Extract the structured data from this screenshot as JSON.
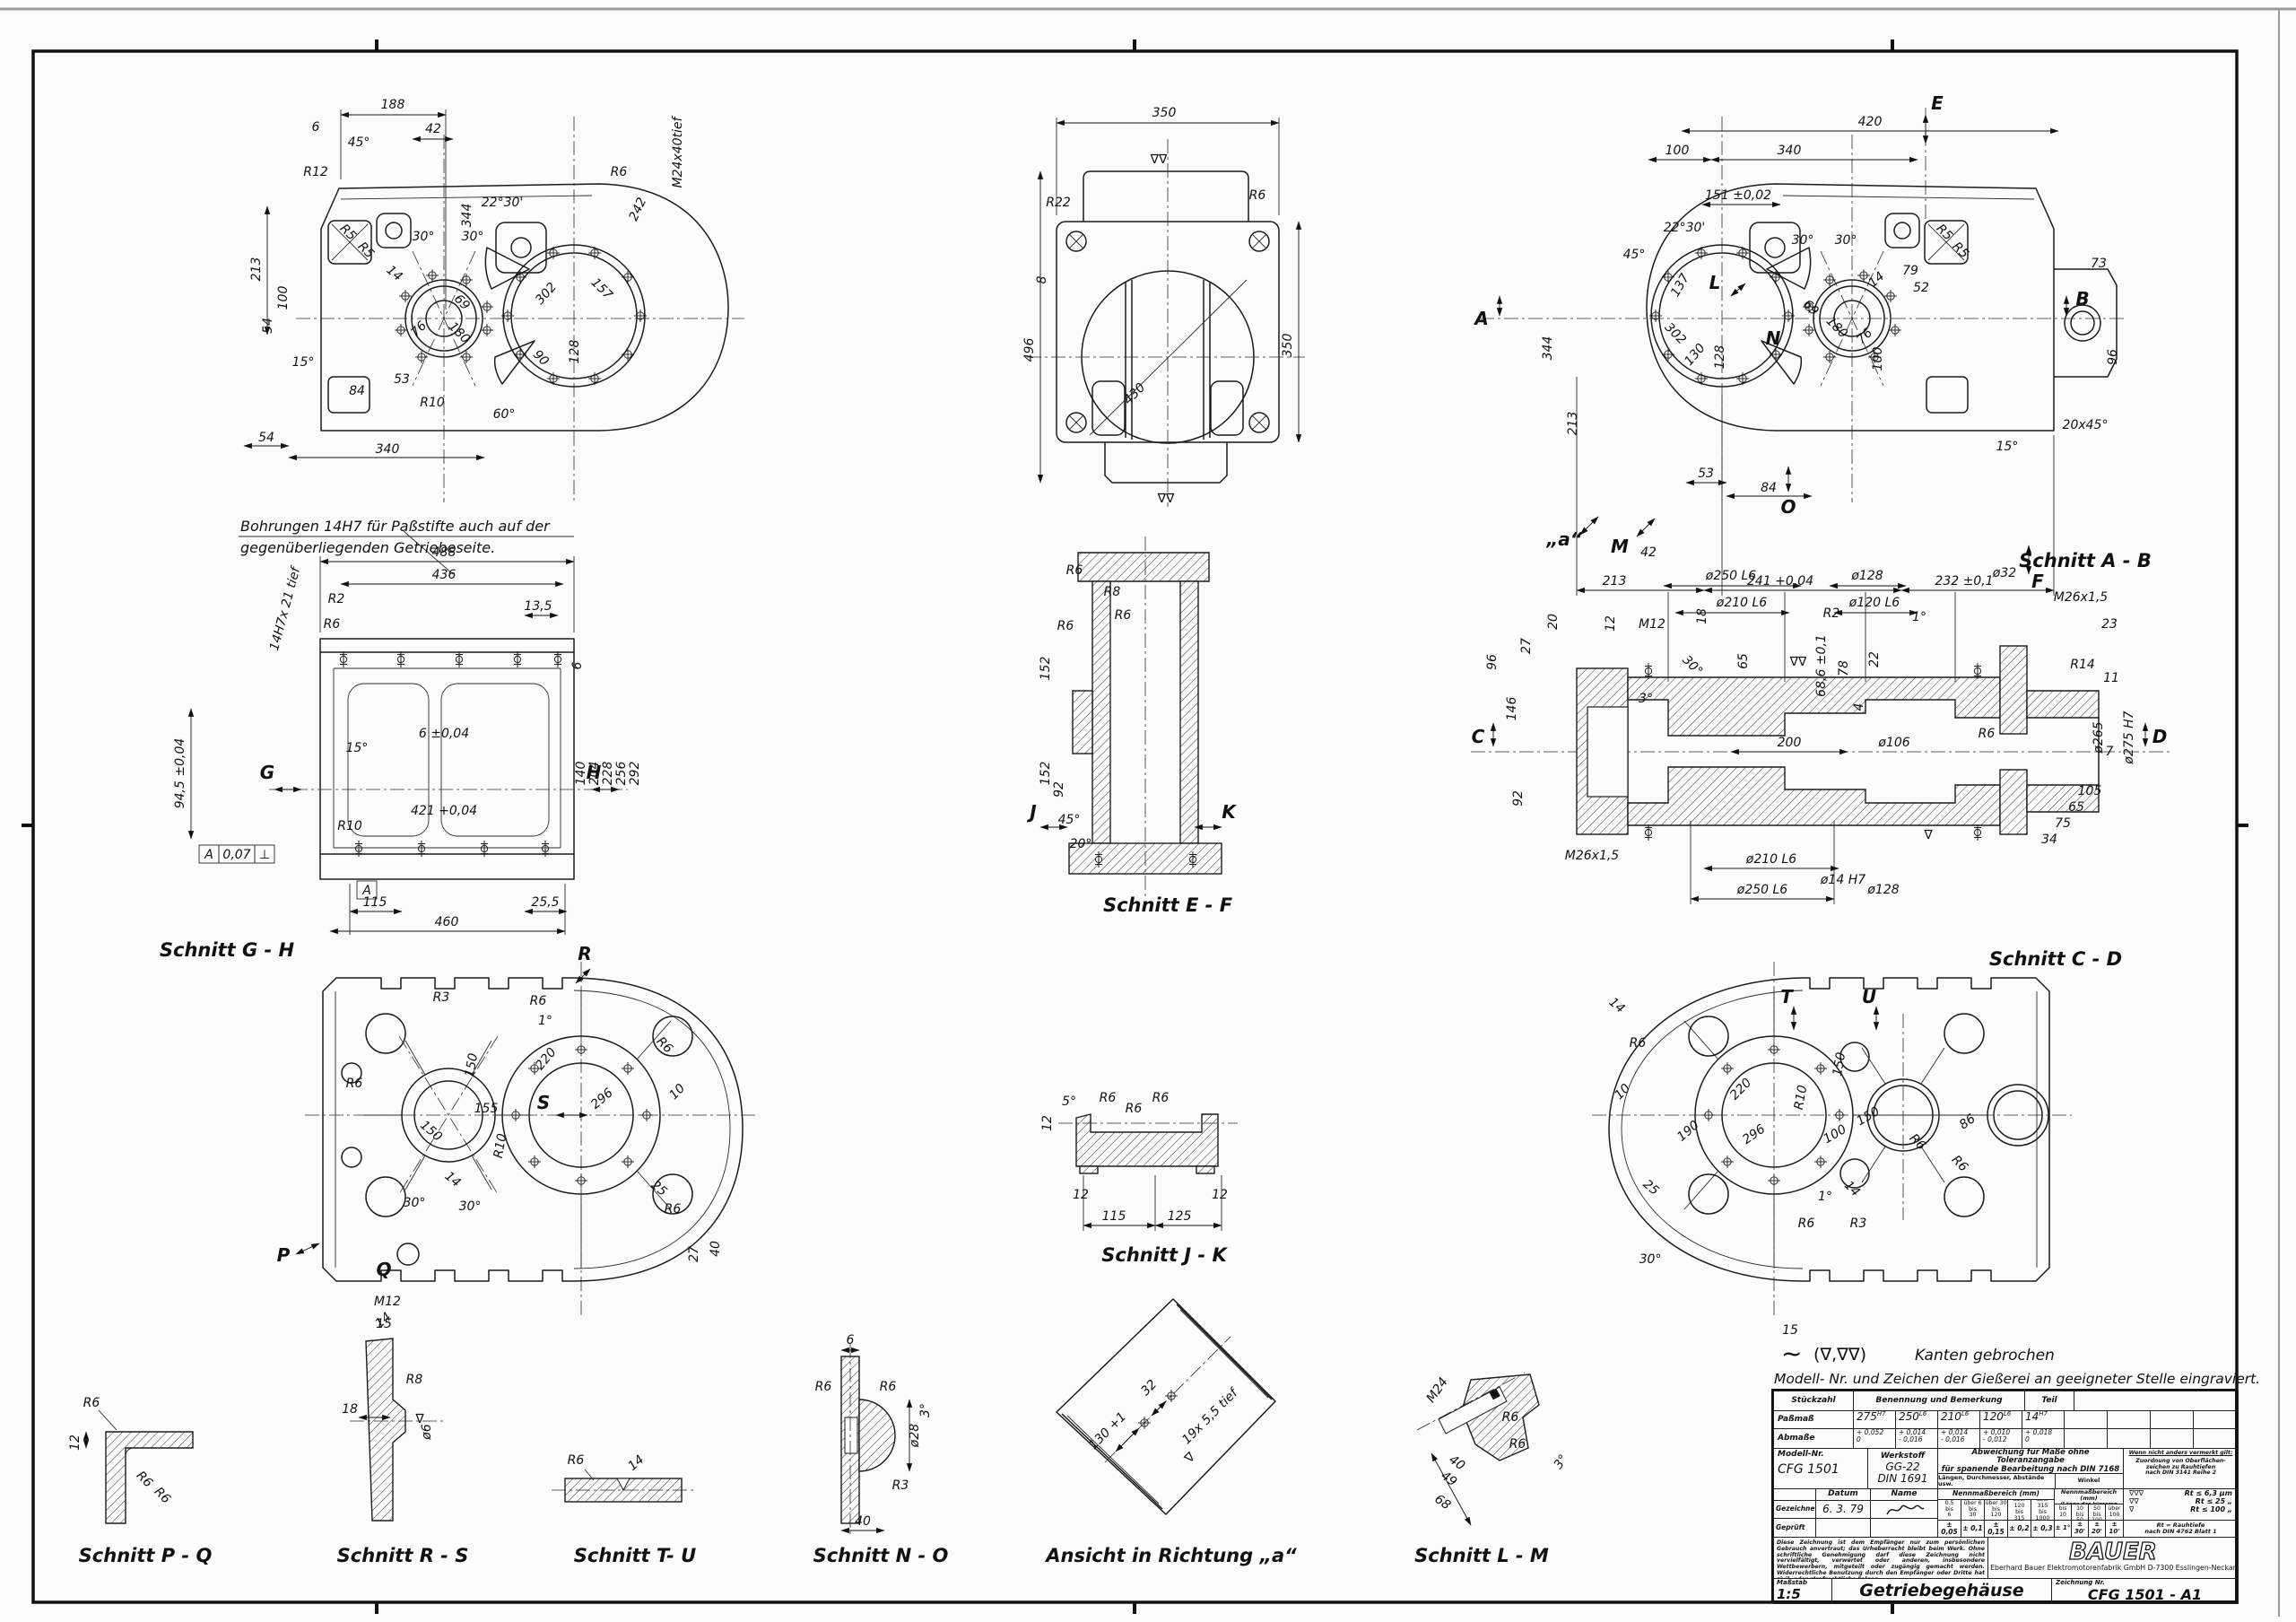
{
  "sheet": {
    "kanten_sym": "~",
    "kanten_tri": "(∇,∇∇)",
    "kanten_text": "Kanten gebrochen",
    "engrave_note": "Modell- Nr. und Zeichen der Gießerei an  geeigneter Stelle eingraviert.",
    "dowel_note1": "Bohrungen 14H7 für Paßstifte auch auf der",
    "dowel_note2": "gegenüberliegenden Getriebeseite.",
    "surf1": "∇",
    "surf2": "∇∇"
  },
  "labels": {
    "gh": "Schnitt G - H",
    "ef": "Schnitt E - F",
    "ab": "Schnitt A - B",
    "cd": "Schnitt C - D",
    "jk": "Schnitt J - K",
    "pq": "Schnitt P - Q",
    "rs": "Schnitt R - S",
    "tu": "Schnitt T- U",
    "no": "Schnitt N - O",
    "va": "Ansicht in Richtung „a“",
    "lm": "Schnitt L - M"
  },
  "views": {
    "plan_left": {
      "dims": [
        "188",
        "6",
        "45°",
        "42",
        "213",
        "344",
        "242",
        "M24x40tief",
        "30°",
        "30°",
        "22°30'",
        "14",
        "69",
        "180",
        "76",
        "302",
        "157",
        "128",
        "90",
        "100",
        "54",
        "15°",
        "84",
        "53",
        "R10",
        "60°",
        "54",
        "340",
        "R6",
        "R12",
        "R5",
        "R5"
      ]
    },
    "end_view": {
      "dims": [
        "350",
        "496",
        "350",
        "430",
        "R22",
        "R6",
        "8"
      ]
    },
    "plan_right": {
      "dims": [
        "420",
        "100",
        "340",
        "151 ±0,02",
        "22°30'",
        "45°",
        "30°",
        "30°",
        "14",
        "79",
        "52",
        "96",
        "73",
        "20x45°",
        "15°",
        "69",
        "180",
        "76",
        "302",
        "130",
        "128",
        "137",
        "100",
        "344",
        "213",
        "53",
        "84",
        "42",
        "213",
        "241 +0,04",
        "232 ±0,1",
        "R5",
        "R5"
      ],
      "letters": {
        "a": "A",
        "b": "B",
        "e": "E",
        "f": "F",
        "l": "L",
        "m": "M",
        "n": "N",
        "o": "O",
        "va": "„a“"
      }
    },
    "front": {
      "dims": [
        "488",
        "436",
        "13,5",
        "R2",
        "14H7x 21 tief",
        "94,5 ±0,04",
        "6 ±0,04",
        "421 +0,04",
        "140",
        "204",
        "228",
        "256",
        "292",
        "R10",
        "115",
        "460",
        "25,5",
        "6",
        "15°",
        "R6"
      ],
      "letters": {
        "g": "G",
        "h": "H"
      },
      "fcf": {
        "d": "A",
        "t": "0,07",
        "s": "⊥",
        "ref": "A"
      }
    },
    "sec_ef": {
      "dims": [
        "R6",
        "R8",
        "R6",
        "R6",
        "152",
        "152",
        "45°",
        "20°",
        "92"
      ],
      "letters": {
        "j": "J",
        "k": "K"
      }
    },
    "sec_ab": {
      "dims": [
        "ø250 L6",
        "ø210 L6",
        "ø128",
        "ø120 L6",
        "ø32",
        "M26x1,5",
        "23",
        "M12",
        "12",
        "20",
        "27",
        "96",
        "146",
        "18",
        "65",
        "68,6 ±0,1",
        "R2",
        "78",
        "22",
        "4",
        "3°",
        "30°",
        "11",
        "R14",
        "ø265",
        "ø275 H7",
        "7",
        "200",
        "ø106",
        "R6",
        "92",
        "M26x1,5",
        "ø210 L6",
        "ø250 L6",
        "ø14 H7",
        "ø128",
        "34",
        "75",
        "65",
        "105",
        "1°"
      ],
      "letters": {
        "c": "C",
        "d": "D"
      }
    },
    "sec_gh": {
      "dims": [
        "R3",
        "R6",
        "1°",
        "150",
        "155",
        "150",
        "14",
        "30°",
        "30°",
        "R10",
        "220",
        "296",
        "25",
        "10",
        "R6",
        "27",
        "40",
        "M12",
        "15",
        "R6",
        "R6"
      ],
      "letters": {
        "p": "P",
        "q": "Q",
        "r": "R",
        "s": "S"
      }
    },
    "sec_jk": {
      "dims": [
        "12",
        "5°",
        "R6",
        "R6",
        "R6",
        "12",
        "115",
        "125",
        "12"
      ]
    },
    "sec_cd": {
      "dims": [
        "14",
        "R6",
        "10",
        "25",
        "190",
        "296",
        "220",
        "150",
        "150",
        "100",
        "86",
        "R10",
        "R6",
        "R6",
        "1°",
        "14",
        "R3",
        "30°",
        "15",
        "R6"
      ],
      "letters": {
        "t": "T",
        "u": "U"
      }
    },
    "det_pq": {
      "dims": [
        "12",
        "R6",
        "R6",
        "R6"
      ]
    },
    "det_rs": {
      "dims": [
        "18",
        "R8",
        "ø6",
        "14"
      ]
    },
    "det_tu": {
      "dims": [
        "R6",
        "14"
      ]
    },
    "det_no": {
      "dims": [
        "6",
        "R6",
        "R6",
        "ø28",
        "3°",
        "R3",
        "40"
      ]
    },
    "det_va": {
      "dims": [
        "130 +1",
        "32",
        "19x 5,5 tief"
      ]
    },
    "det_lm": {
      "dims": [
        "M24",
        "R6",
        "R6",
        "40",
        "49",
        "68",
        "3°"
      ]
    }
  },
  "title_block": {
    "stueckzahl": "Stückzahl",
    "benennung": "Benennung und Bemerkung",
    "teil": "Teil",
    "passmass_label": "Paßmaß",
    "passmass": [
      {
        "v": "275",
        "t": "H7"
      },
      {
        "v": "250",
        "t": "L6"
      },
      {
        "v": "210",
        "t": "L6"
      },
      {
        "v": "120",
        "t": "L6"
      },
      {
        "v": "14",
        "t": "H7"
      }
    ],
    "abmasse_label": "Abmaße",
    "abmasse": [
      {
        "o": "+ 0,052",
        "u": "0"
      },
      {
        "o": "+ 0,014",
        "u": "- 0,016"
      },
      {
        "o": "+ 0,014",
        "u": "- 0,016"
      },
      {
        "o": "+ 0,010",
        "u": "- 0,012"
      },
      {
        "o": "+ 0,018",
        "u": "0"
      }
    ],
    "modell_label": "Modell-Nr.",
    "modell": "CFG 1501",
    "werkstoff_label": "Werkstoff",
    "werkstoff1": "GG-22",
    "werkstoff2": "DIN 1691",
    "abw1": "Abweichung für Maße ohne Toleranzangabe",
    "abw2": "für spanende Bearbeitung nach DIN 7168",
    "laengen": "Längen, Durchmesser, Abstände usw.",
    "winkel": "Winkel",
    "wenn": "Wenn nicht anders vermerkt gilt:",
    "zuordnung": "Zuordnung von Oberflächen-\nzeichen zu Rauhtiefen\nnach DIN 3141 Reihe 2",
    "datum": "Datum",
    "name": "Name",
    "gezeichnet": "Gezeichnet",
    "geprueft": "Geprüft",
    "gez_datum": "6. 3. 79",
    "nenn1": "Nennmaßbereich (mm)",
    "nenn2": "Nennmaßbereich (mm)",
    "nenn2b": "(Länge des kürzeren Schenkels)",
    "len_ranges": [
      "0,5\nbis\n6",
      "über 6\nbis\n30",
      "über 30\nbis\n120",
      "über 120\nbis\n315",
      "über 315\nbis\n1000"
    ],
    "len_tols": [
      "± 0,05",
      "± 0,1",
      "± 0,15",
      "± 0,2",
      "± 0,3"
    ],
    "ang_ranges": [
      "bis 10",
      "über 10\nbis 50",
      "über 50\nbis 100",
      "über 100"
    ],
    "ang_tols": [
      "± 1°",
      "± 30'",
      "± 20'",
      "± 10'"
    ],
    "rt_rows": [
      {
        "s": "∇∇∇",
        "t": "Rt ≤ 6,3 µm"
      },
      {
        "s": "∇∇",
        "t": "Rt ≤ 25 „"
      },
      {
        "s": "∇",
        "t": "Rt ≤ 100 „"
      }
    ],
    "rt_note": "Rt = Rauhtiefe\nnach DIN 4762 Blatt 1",
    "legal": "Diese Zeichnung ist dem Empfänger nur zum persönlichen Gebrauch anvertraut; das Urheberrecht bleibt beim Werk. Ohne schriftliche Genehmigung darf diese Zeichnung nicht vervielfältigt, verwertet oder anderen, insbesondere Wettbewerbern, mitgeteilt oder zugängig gemacht werden. Widerrechtliche Benutzung durch den Empfänger oder Dritte hat zivil- oder strafrechtliche Folgen.",
    "brand": "BAUER",
    "company": "Eberhard Bauer  Elektromotorenfabrik GmbH  D-7300 Esslingen-Neckar",
    "massstab_label": "Maßstab",
    "massstab": "1:5",
    "title": "Getriebegehäuse",
    "znr_label": "Zeichnung Nr.",
    "znr": "CFG 1501 - A1"
  }
}
